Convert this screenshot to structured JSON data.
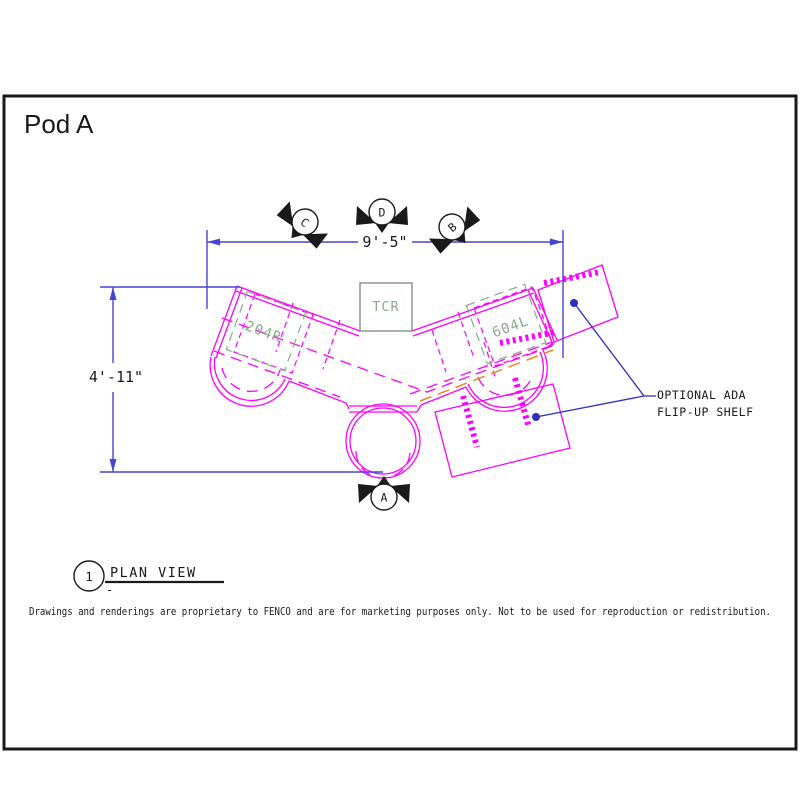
{
  "title": "Pod A",
  "colors": {
    "ink": "#1a1a1a",
    "magenta": "#ff00ff",
    "dim_blue": "#4545d4",
    "leader_blue": "#2d2dbe",
    "green_dark": "#6e7f6e",
    "green_text": "#8aa88a",
    "orange": "#f5821f"
  },
  "dimensions": {
    "width": "9'-5\"",
    "height": "4'-11\""
  },
  "section_markers": {
    "c": "C",
    "d": "D",
    "b": "B",
    "a": "A"
  },
  "equipment": {
    "tcr": "TCR",
    "left_unit": "204R",
    "right_unit": "604L"
  },
  "callout": {
    "line1": "OPTIONAL ADA",
    "line2": "FLIP-UP SHELF"
  },
  "detail": {
    "number": "1",
    "label": "PLAN VIEW",
    "sub": "-"
  },
  "footer": {
    "disclaimer": "Drawings and renderings are proprietary to FENCO and are for marketing purposes only.  Not to be used for reproduction or redistribution."
  }
}
